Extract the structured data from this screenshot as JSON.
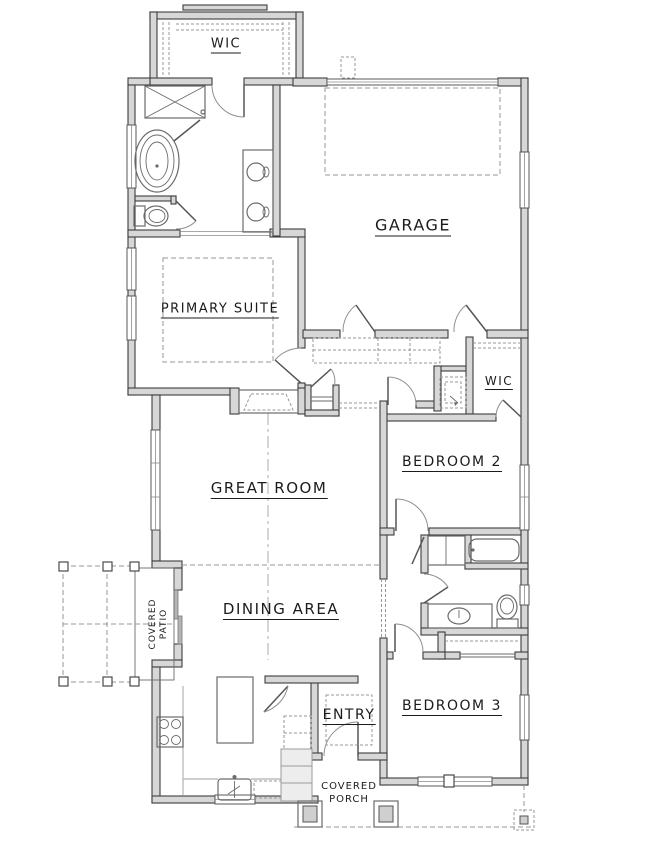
{
  "plan": {
    "type": "single-story-house-floor-plan",
    "style": "architectural-blueprint-line-drawing"
  },
  "labels": {
    "wic_top": "WIC",
    "garage": "GARAGE",
    "primary_suite": "PRIMARY SUITE",
    "wic_2": "WIC",
    "bedroom_2": "BEDROOM 2",
    "great_room": "GREAT ROOM",
    "dining_area": "DINING AREA",
    "covered_patio_line1": "COVERED",
    "covered_patio_line2": "PATIO",
    "entry": "ENTRY",
    "bedroom_3": "BEDROOM 3",
    "covered_porch_line1": "COVERED",
    "covered_porch_line2": "PORCH"
  },
  "colors": {
    "background": "#ffffff",
    "wall_fill": "#d7d7d7",
    "wall_stroke": "#3d3d3d",
    "fixture_stroke": "#6b6b6b",
    "dashed_line": "#979797",
    "label": "#1b1b1b"
  },
  "fixtures": [
    "closet-rods",
    "shower",
    "freestanding-tub",
    "primary-toilet",
    "double-vanity",
    "fireplace",
    "hall-closet",
    "mudroom-built-ins",
    "water-heater",
    "garage-storage-dashed",
    "hall-bathtub",
    "linen-closet",
    "hall-vanity",
    "hall-toilet",
    "bedroom3-closet",
    "kitchen-island",
    "range-cooktop",
    "kitchen-sink",
    "dishwasher",
    "refrigerator",
    "corner-pantry",
    "sliding-glass-door",
    "entry-steps",
    "porch-posts",
    "patio-posts",
    "tray-ceiling-dashed",
    "ridge-line"
  ]
}
